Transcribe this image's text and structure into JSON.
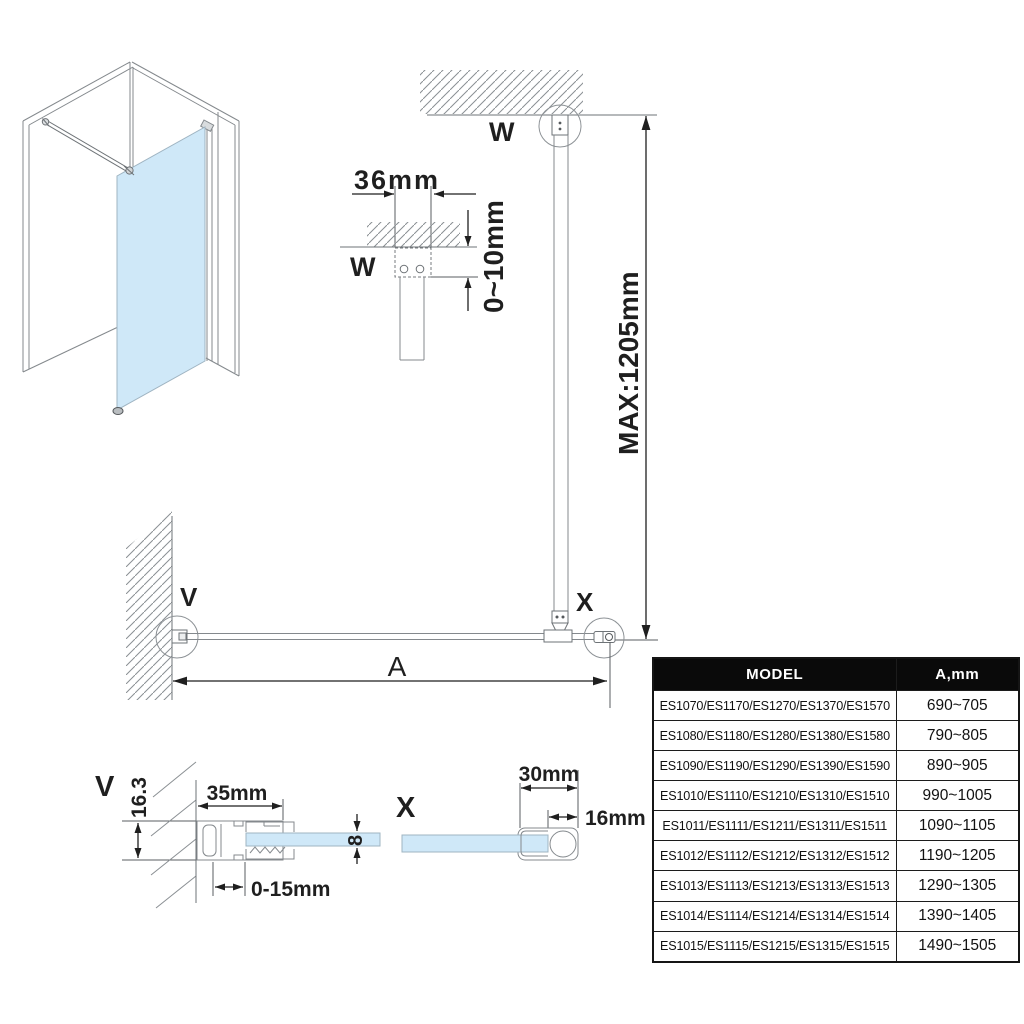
{
  "colors": {
    "glass": "#cfe8f8",
    "outline": "#84898d",
    "dimension": "#1f1f1f",
    "table_header_bg": "#0a0a0a",
    "table_header_fg": "#ffffff"
  },
  "elevation": {
    "anchor_label": "W",
    "max_height": "MAX:1205mm"
  },
  "detail_w": {
    "label": "W",
    "bracket_width": "36mm",
    "ceiling_gap": "0~10mm"
  },
  "plan": {
    "wall_label": "V",
    "end_label": "X",
    "span_label": "A"
  },
  "detail_v": {
    "label": "V",
    "profile_height": "16.3",
    "profile_width": "35mm",
    "glass_thickness": "8",
    "adjustment": "0-15mm"
  },
  "detail_x": {
    "label": "X",
    "cap_width": "30mm",
    "cap_depth": "16mm"
  },
  "table": {
    "headers": [
      "MODEL",
      "A,mm"
    ],
    "rows": [
      {
        "model": "ES1070/ES1170/ES1270/ES1370/ES1570",
        "a": "690~705"
      },
      {
        "model": "ES1080/ES1180/ES1280/ES1380/ES1580",
        "a": "790~805"
      },
      {
        "model": "ES1090/ES1190/ES1290/ES1390/ES1590",
        "a": "890~905"
      },
      {
        "model": "ES1010/ES1110/ES1210/ES1310/ES1510",
        "a": "990~1005"
      },
      {
        "model": "ES1011/ES1111/ES1211/ES1311/ES1511",
        "a": "1090~1105"
      },
      {
        "model": "ES1012/ES1112/ES1212/ES1312/ES1512",
        "a": "1190~1205"
      },
      {
        "model": "ES1013/ES1113/ES1213/ES1313/ES1513",
        "a": "1290~1305"
      },
      {
        "model": "ES1014/ES1114/ES1214/ES1314/ES1514",
        "a": "1390~1405"
      },
      {
        "model": "ES1015/ES1115/ES1215/ES1315/ES1515",
        "a": "1490~1505"
      }
    ]
  }
}
